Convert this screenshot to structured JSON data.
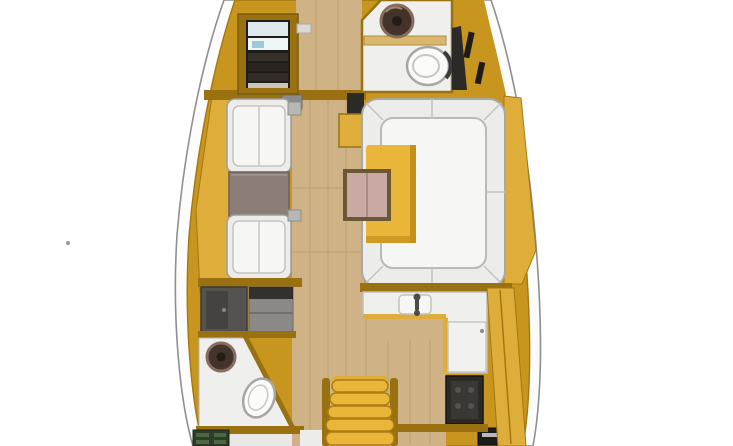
{
  "scene": {
    "type": "sailboat-interior-floor-plan",
    "view": "top-down",
    "orientation": "bow-at-top",
    "visible_text": "none"
  },
  "palette": {
    "bg": "#ffffff",
    "hull": "#fcfcfc",
    "hull_stroke": "#8f8f8f",
    "deck_stroke": "#a3780f",
    "wood": "#c8951f",
    "wood_light": "#dfae3a",
    "wood_dark": "#9a7110",
    "floor": "#cfb285",
    "floor_seam": "#b3945f",
    "white_room": "#efefed",
    "upholstery": "#ececea",
    "upholstery_hi": "#f6f6f4",
    "upholstery_line": "#b9b9b7",
    "table_yellow": "#e9b63a",
    "table_yellow_dark": "#c68f1c",
    "table_pink": "#c9a9a3",
    "table_pink_frame": "#6b5636",
    "table_gray": "#8d7d77",
    "dark": "#2c2a26",
    "gray_fixture": "#8b8985",
    "shower": "#55534f",
    "green_dark": "#2f3b2b",
    "sink": "#43332a",
    "sink_ring": "#866d5d",
    "toilet_stroke": "#a6a6a4"
  },
  "regions": {
    "forward_cabin": {
      "fixtures": [
        "wardrobe-locker-with-shelves",
        "bulkhead",
        "mast-step"
      ]
    },
    "forward_head": {
      "fixtures": [
        "round-sink-basin",
        "toilet",
        "shelf",
        "hull-locker"
      ]
    },
    "saloon_port": {
      "fixtures": [
        "armchair-forward",
        "gray-table",
        "armchair-aft",
        "sideboard"
      ]
    },
    "saloon_starboard": {
      "fixtures": [
        "u-shaped-settee",
        "yellow-saloon-table",
        "pink-folding-leaf-table",
        "speaker-box",
        "side-locker"
      ]
    },
    "aft_port": {
      "fixtures": [
        "shower-stall",
        "wardrobe",
        "round-sink-basin",
        "toilet",
        "green-cabinet"
      ]
    },
    "galley_starboard": {
      "fixtures": [
        "l-shaped-counter",
        "sink",
        "faucet",
        "fridge",
        "stove",
        "oven",
        "hull-cabinet-band"
      ]
    },
    "companionway": {
      "fixtures": [
        "curved-steps",
        "step-rails"
      ]
    }
  }
}
